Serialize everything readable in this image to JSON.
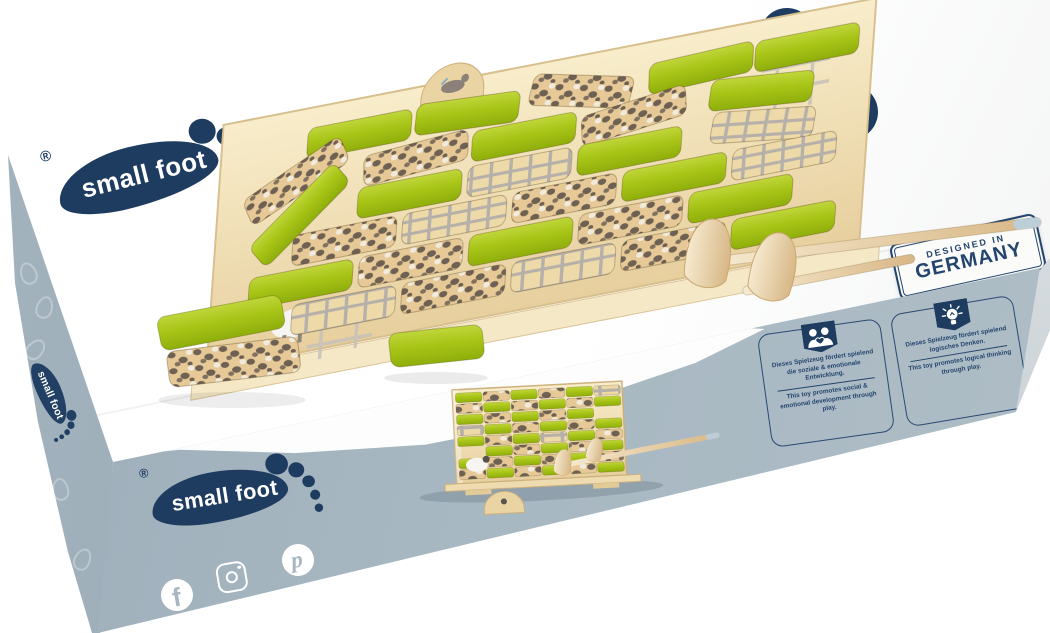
{
  "brand": {
    "name": "small foot",
    "registered_mark": "®"
  },
  "lid": {
    "badges": {
      "age": "4+",
      "material": "WOOD",
      "players": "1-2"
    },
    "stamp": {
      "line1": "DESIGNED IN",
      "line2": "GERMANY"
    }
  },
  "front": {
    "info_cards": [
      {
        "icon": "people-heart-icon",
        "text_de": "Dieses Spielzeug fördert spielend die soziale & emotionale Entwicklung.",
        "text_en": "This toy promotes social & emotional development through play."
      },
      {
        "icon": "lightbulb-icon",
        "text_de": "Dieses Spielzeug fördert spielend logisches Denken.",
        "text_en": "This toy promotes logical thinking through play."
      }
    ],
    "social_icons": [
      "facebook",
      "instagram",
      "pinterest"
    ]
  },
  "colors": {
    "navy": "#1e3b60",
    "box_blue": "#a6b6c1",
    "block_green": "#a6c316",
    "wood": "#ecd6a6"
  }
}
